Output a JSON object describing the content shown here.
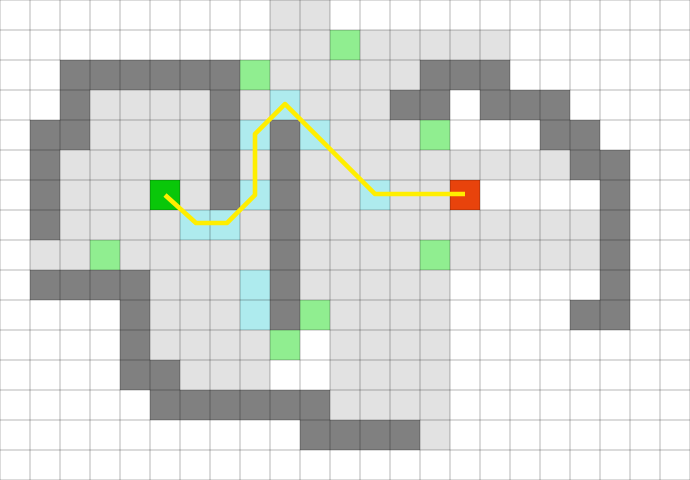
{
  "map": {
    "cols": 23,
    "rows": 16,
    "cell_size": 30,
    "background_color": "#ffffff",
    "grid_line_color": "rgba(0,0,0,0.19)",
    "grid_line_width": 1.5,
    "cell_types": {
      "W": {
        "name": "empty",
        "color": "#ffffff"
      },
      "F": {
        "name": "floor",
        "color": "#e2e2e2"
      },
      "D": {
        "name": "wall",
        "color": "#808080"
      },
      "C": {
        "name": "cyan",
        "color": "#aeebee"
      },
      "G": {
        "name": "light-green",
        "color": "#90ee90"
      },
      "S": {
        "name": "start",
        "color": "#09c709"
      },
      "R": {
        "name": "goal",
        "color": "#e8430c"
      }
    },
    "rows_data": [
      "WWWWWWWWWFFWWWWWWWWWWWW",
      "WWWWWWWWWFFGFFFFFWWWWWW",
      "WWDDDDDDGFFFFFDDDWWWWWW",
      "WWDFFFFDFCFFFDDWDDDWWWW",
      "WDDFFFFDCDCFFFGWWWDDWWW",
      "WDFFFFFDFDFFFFFFFFFDDWW",
      "WDFFFSFDCDFFCFFRWWWWDWW",
      "WDFFFFCCFDFFFFFFFFFFDWW",
      "WFFGFFFFFDFFFFGFFFFFDWW",
      "WDDDDFFFCDFFFFFWWWWWDWW",
      "WWWWDFFFCDGFFFFWWWWDDWW",
      "WWWWDFFFFGWFFFFWWWWWWWW",
      "WWWWDDFFFWWFFFFWWWWWWWW",
      "WWWWWDDDDDDFFFFWWWWWWWW",
      "WWWWWWWWWWDDDDFWWWWWWWW",
      "WWWWWWWWWWWWWWWWWWWWWWW"
    ],
    "start_cell": {
      "col": 5,
      "row": 6
    },
    "goal_cell": {
      "col": 15,
      "row": 6
    },
    "path": {
      "color": "#ffee00",
      "width": 4.6,
      "points": [
        [
          165,
          195
        ],
        [
          196,
          223
        ],
        [
          227,
          223
        ],
        [
          255,
          195
        ],
        [
          255,
          134
        ],
        [
          285,
          104
        ],
        [
          375,
          194
        ],
        [
          465,
          194
        ]
      ]
    }
  }
}
